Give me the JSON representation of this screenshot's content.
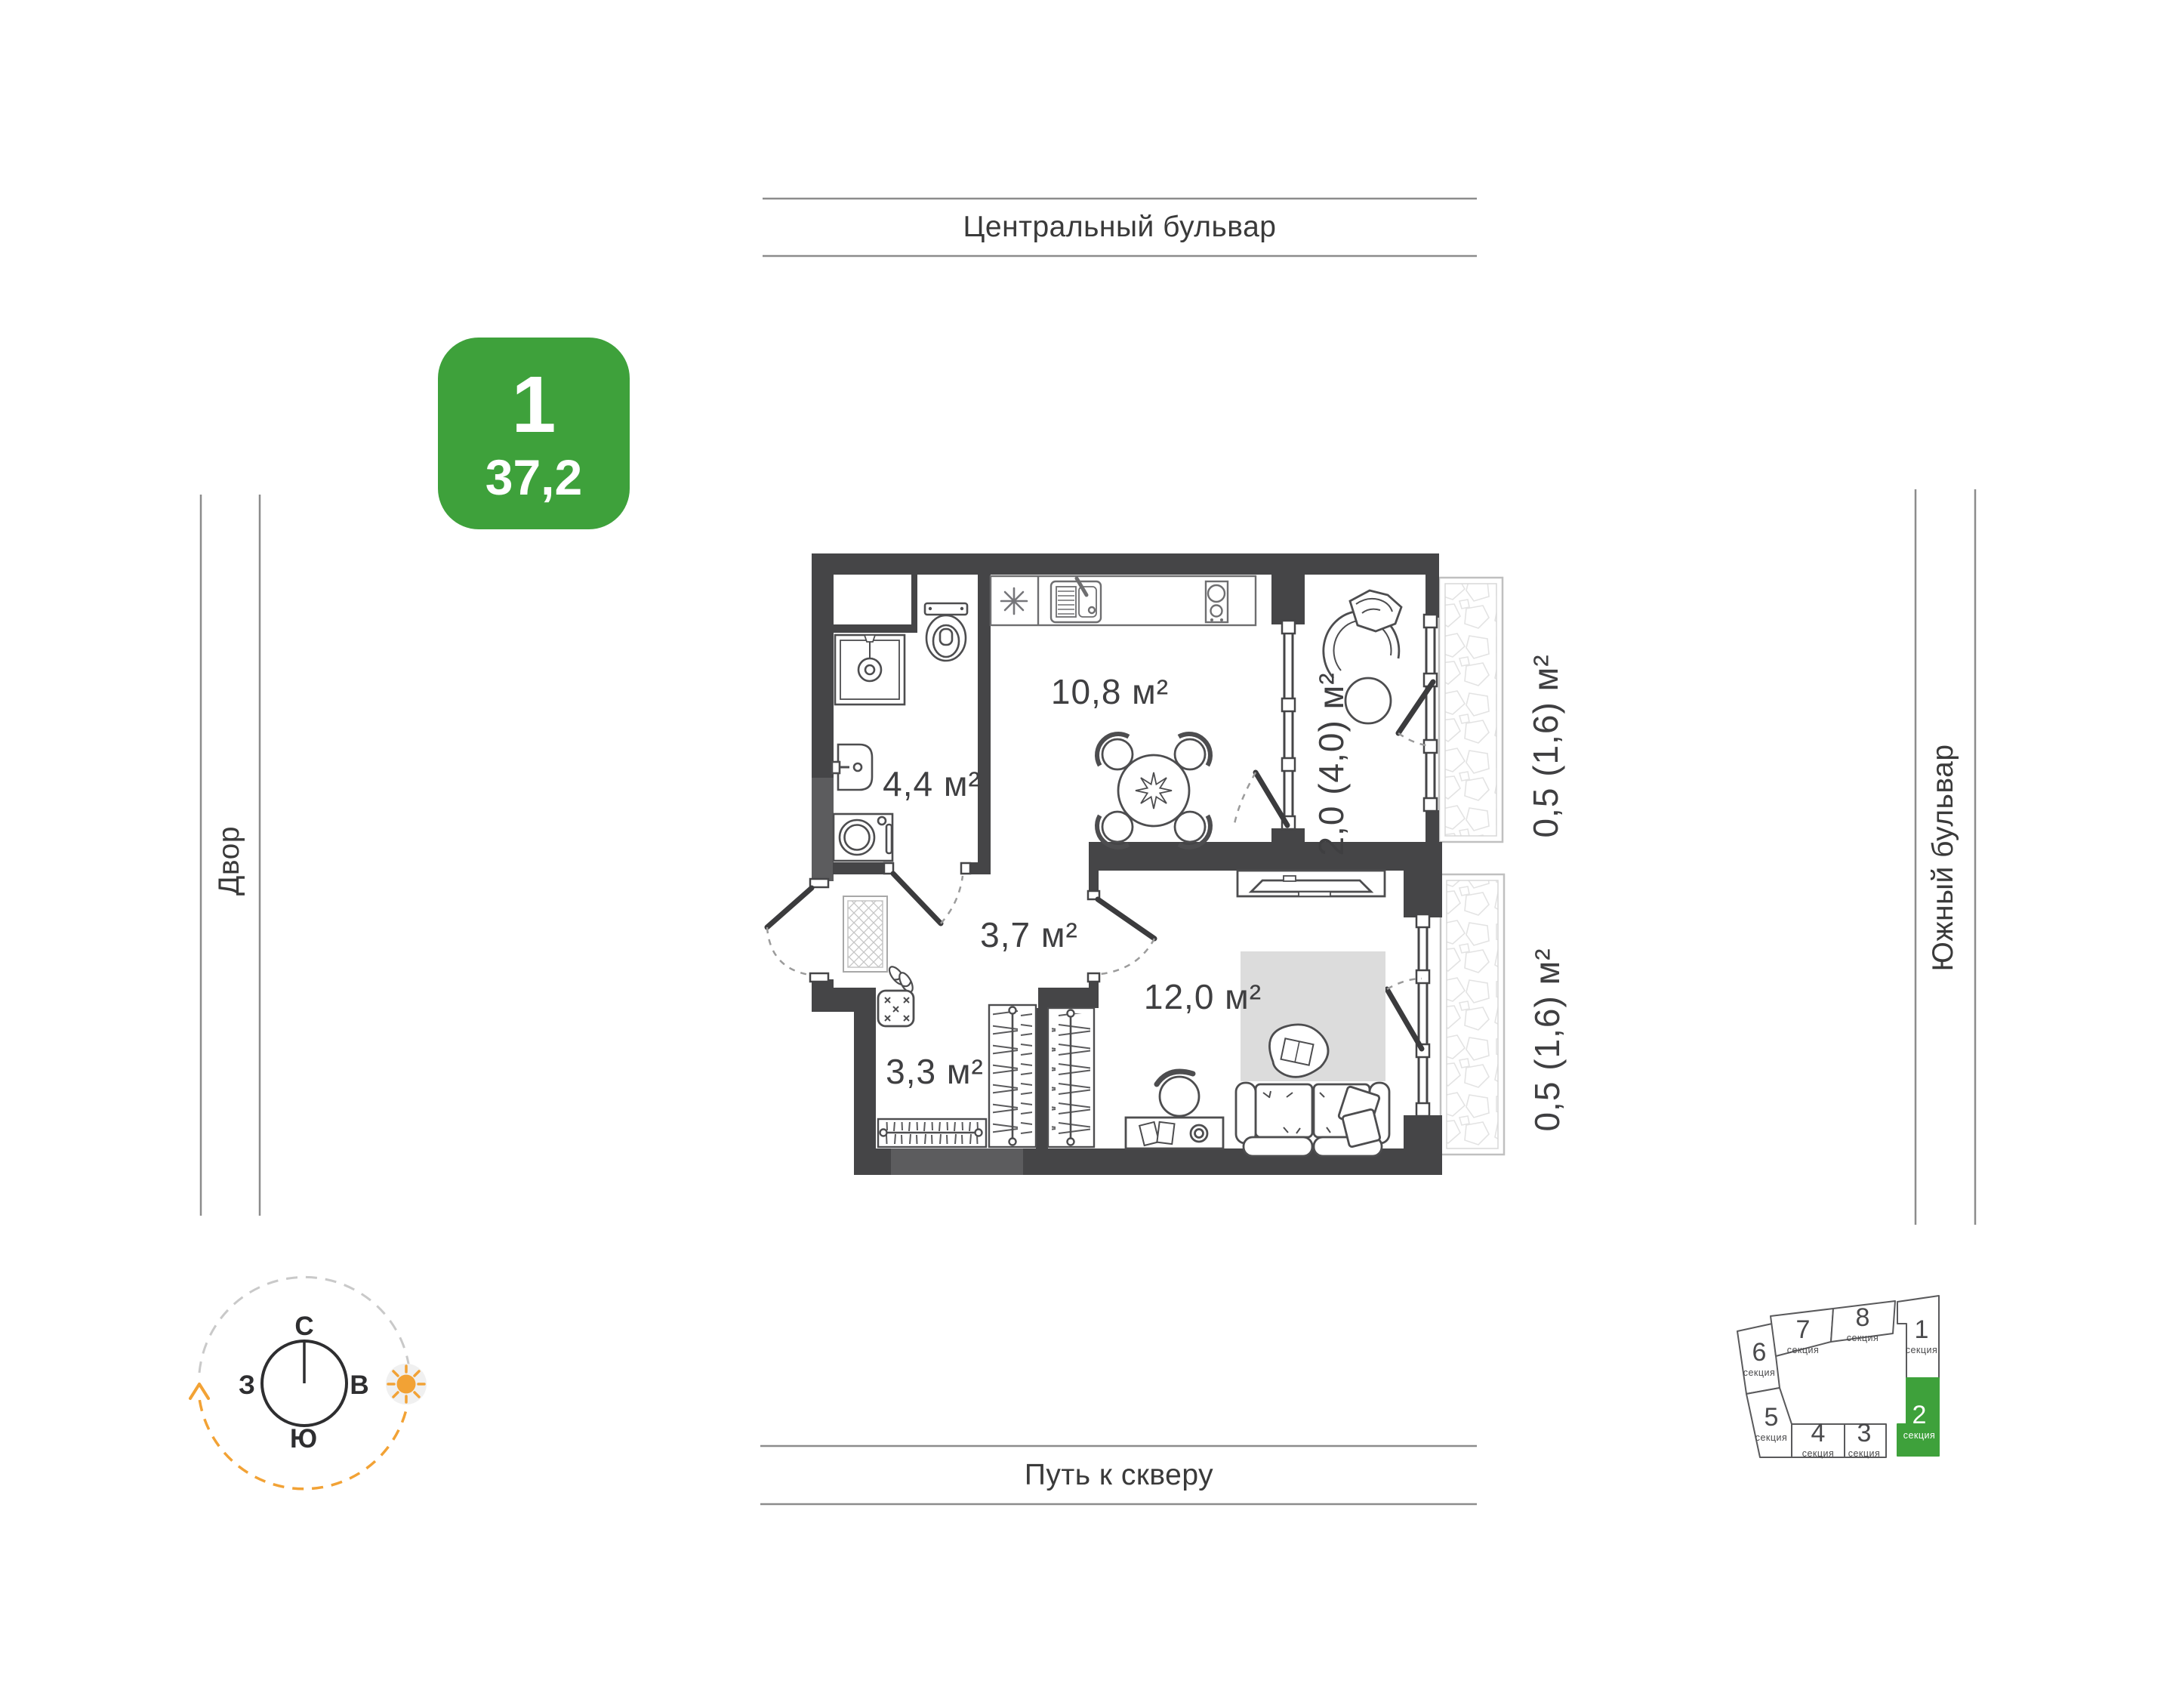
{
  "streets": {
    "top": "Центральный бульвар",
    "bottom": "Путь к скверу",
    "left": "Двор",
    "right": "Южный бульвар"
  },
  "badge": {
    "rooms": "1",
    "area": "37,2"
  },
  "plan": {
    "rooms": {
      "kitchen": {
        "label": "10,8 м²"
      },
      "bathroom": {
        "label": "4,4 м²"
      },
      "hallway": {
        "label": "3,7 м²"
      },
      "living": {
        "label": "12,0 м²"
      },
      "wardrobe": {
        "label": "3,3 м²"
      },
      "loggia": {
        "label": "2,0 (4,0) м²"
      },
      "balcony_top": {
        "label": "0,5 (1,6) м²"
      },
      "balcony_bottom": {
        "label": "0,5 (1,6) м²"
      }
    }
  },
  "compass": {
    "north": "С",
    "south": "Ю",
    "west": "З",
    "east": "В"
  },
  "masterplan": {
    "highlight_color": "#3EA13B",
    "sections": [
      {
        "num": "1",
        "label": "секция",
        "highlighted": false
      },
      {
        "num": "2",
        "label": "секция",
        "highlighted": true
      },
      {
        "num": "3",
        "label": "секция",
        "highlighted": false
      },
      {
        "num": "4",
        "label": "секция",
        "highlighted": false
      },
      {
        "num": "5",
        "label": "секция",
        "highlighted": false
      },
      {
        "num": "6",
        "label": "секция",
        "highlighted": false
      },
      {
        "num": "7",
        "label": "секция",
        "highlighted": false
      },
      {
        "num": "8",
        "label": "секция",
        "highlighted": false
      }
    ]
  },
  "colors": {
    "accent_green": "#3EA13B",
    "wall": "#454547",
    "sun_orange": "#F2A235"
  }
}
